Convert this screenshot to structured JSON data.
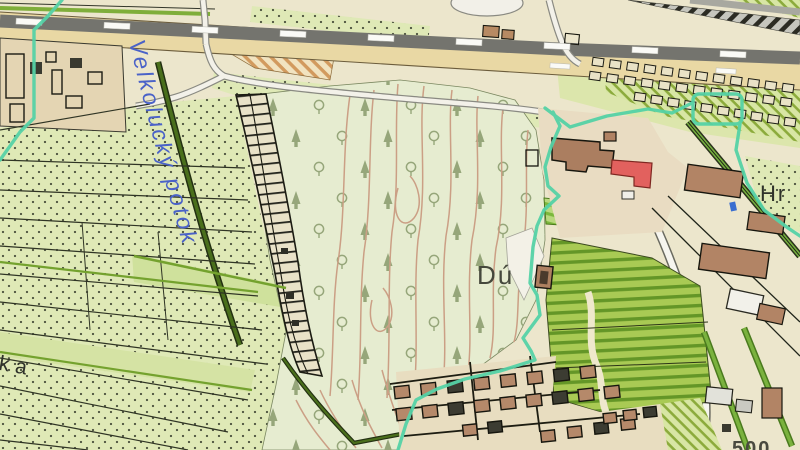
{
  "map": {
    "labels": {
      "stream": "Velkolucký potok",
      "hill": "Dú",
      "place_right": "Hr",
      "place_left": "ka",
      "bottom_right_number": "500"
    },
    "colors": {
      "base_cream": "#ece6cc",
      "parcel_green": "#dfe9b6",
      "forest_green": "#e6ecd0",
      "contour_brown": "#cb9f85",
      "boundary_cyan": "#55d2a6",
      "road_tan": "#e9d8a4",
      "road_gray": "#74746e",
      "building_brown": "#b28465",
      "building_red": "#e2615e",
      "stream_label_blue": "#4a62c8",
      "hatch_orange": "#d29a5e",
      "garden_green": "#8cab3c",
      "field_green": "#7cb83c"
    },
    "icons": {
      "forest_symbols": [
        "deciduous-tree-icon",
        "conifer-tree-icon"
      ],
      "water_marker": "water-feature-icon",
      "road_markers": "road-dash-icon"
    }
  }
}
